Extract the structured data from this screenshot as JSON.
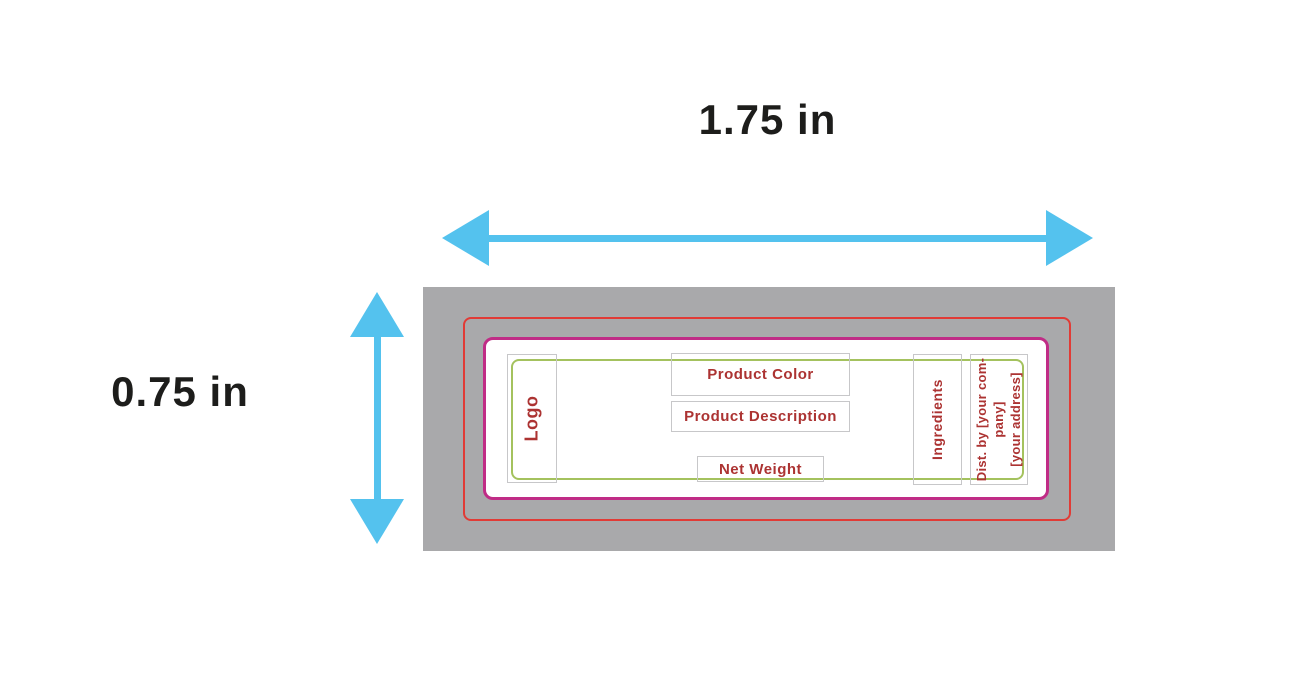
{
  "diagram": {
    "width_dimension": "1.75 in",
    "height_dimension": "0.75 in"
  },
  "label_template": {
    "logo": "Logo",
    "product_color": "Product Color",
    "product_description": "Product Description",
    "net_weight": "Net Weight",
    "ingredients": "Ingredients",
    "distribution_lines": [
      "Dist. by [your com-",
      "pany]",
      "[your address]"
    ]
  },
  "colors": {
    "arrow_cyan": "#54c2ee",
    "bleed_gray": "#a9a9ab",
    "cut_line_red": "#e13b36",
    "label_border_magenta": "#c02c86",
    "safe_area_green": "#a4c25e",
    "placeholder_text_red": "#ac3332",
    "dimension_text_black": "#1d1d1b"
  }
}
